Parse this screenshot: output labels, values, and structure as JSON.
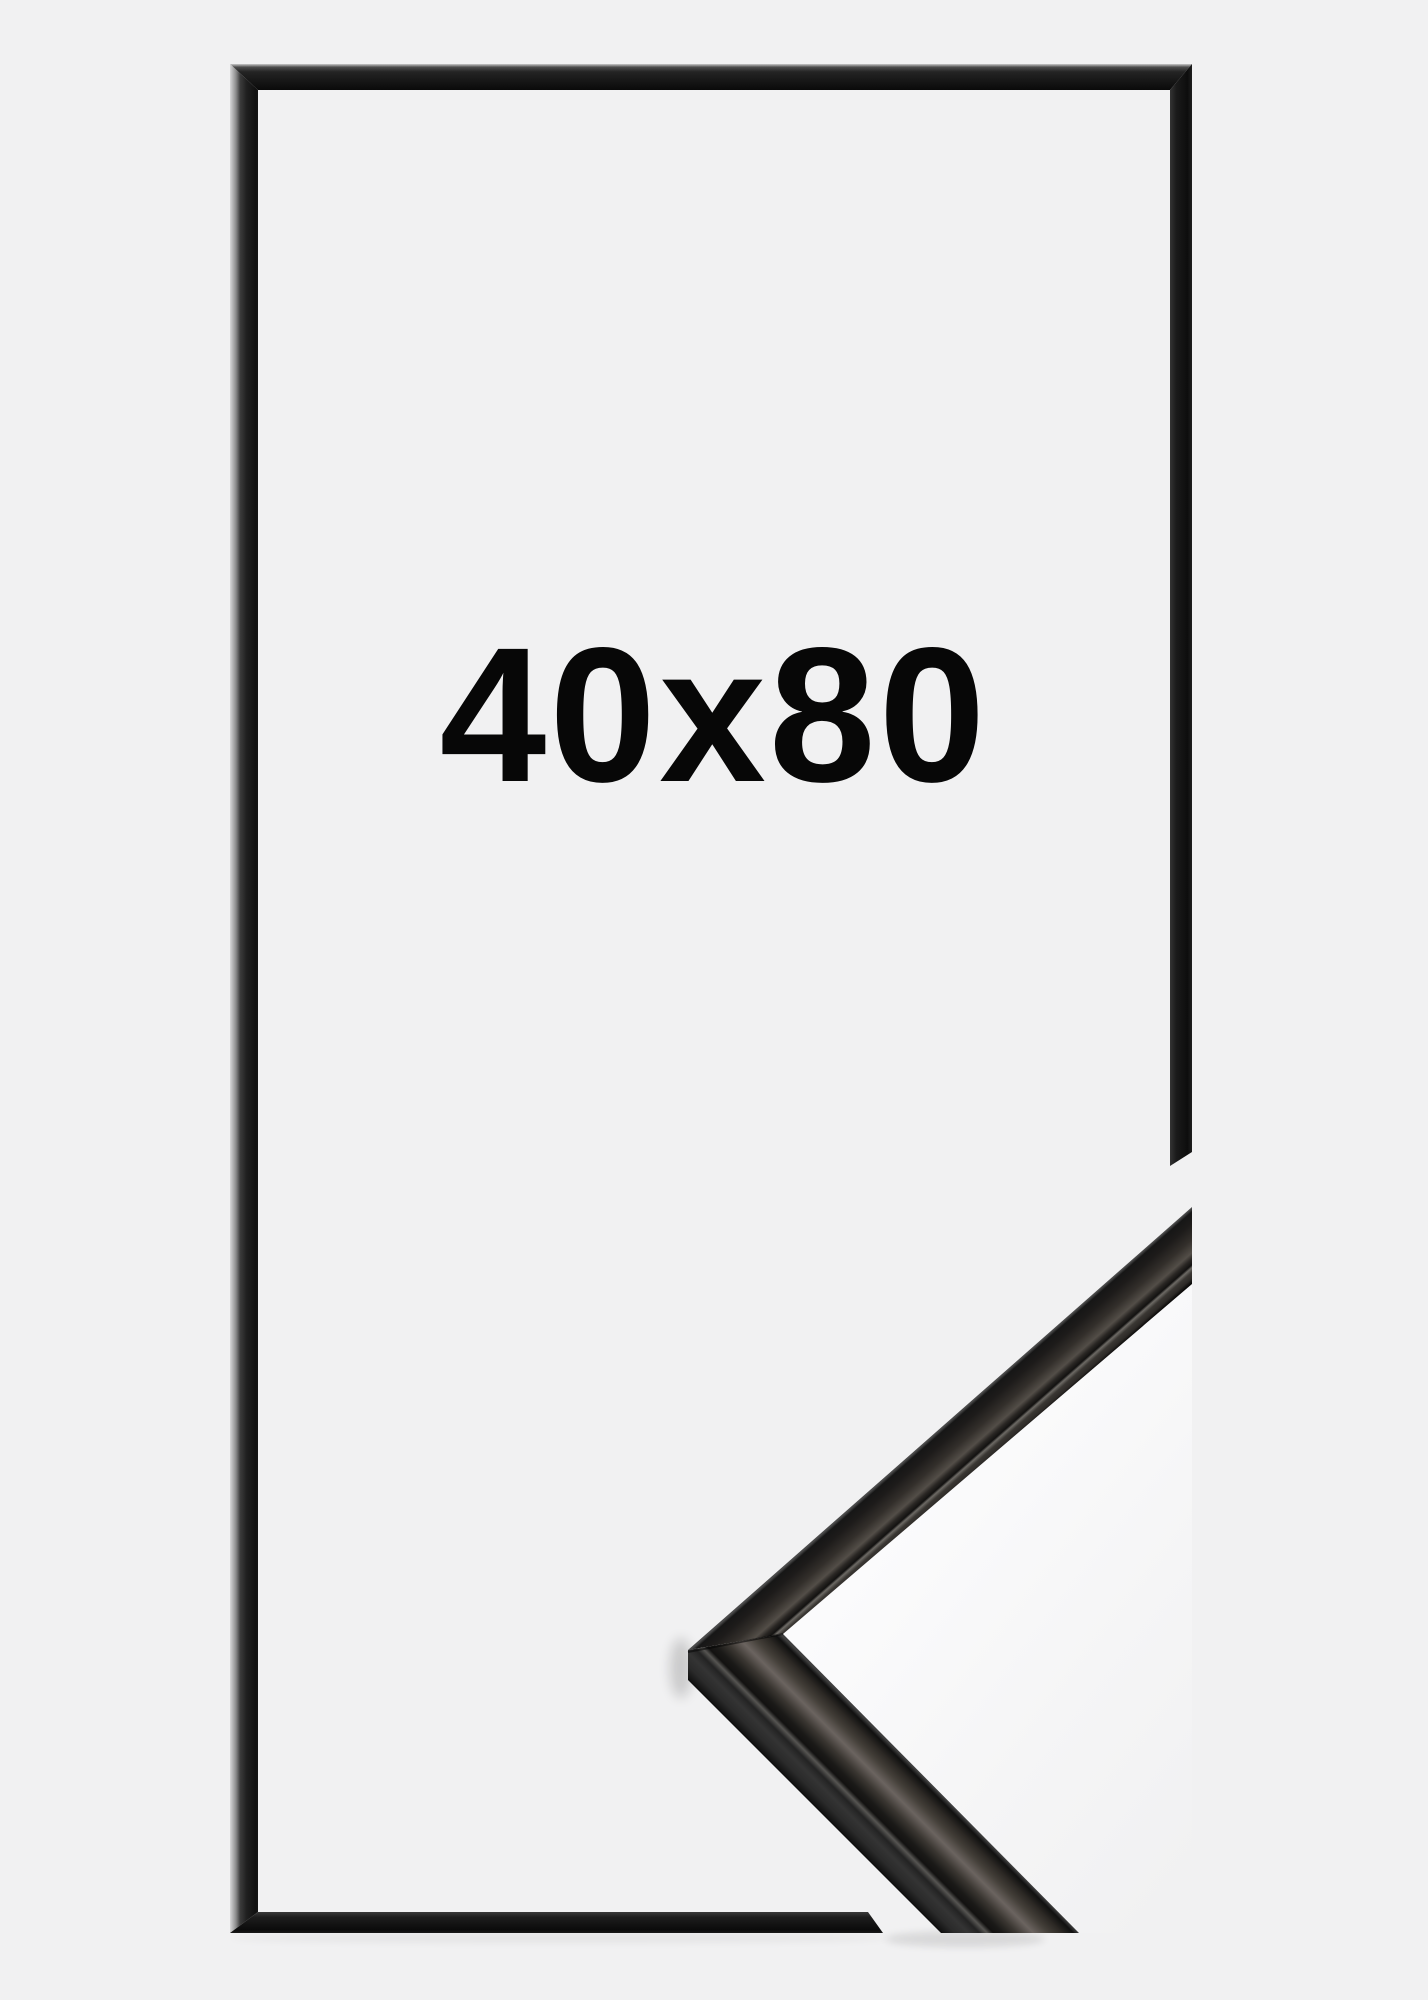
{
  "meta": {
    "description": "Product mockup of a thin black picture frame shown as an outline, with a close-up corner profile detail photo overlapping the bottom-right edge"
  },
  "product": {
    "size_label": "40x80"
  },
  "colors": {
    "background": "#f1f1f2",
    "frame_dark": "#141414",
    "frame_highlight": "#d8d8d9",
    "detail_brushed_metal": "#6b6460",
    "detail_side_face": "#343434",
    "label_text": "#070707",
    "detail_backdrop_white": "#fbfbfc"
  }
}
